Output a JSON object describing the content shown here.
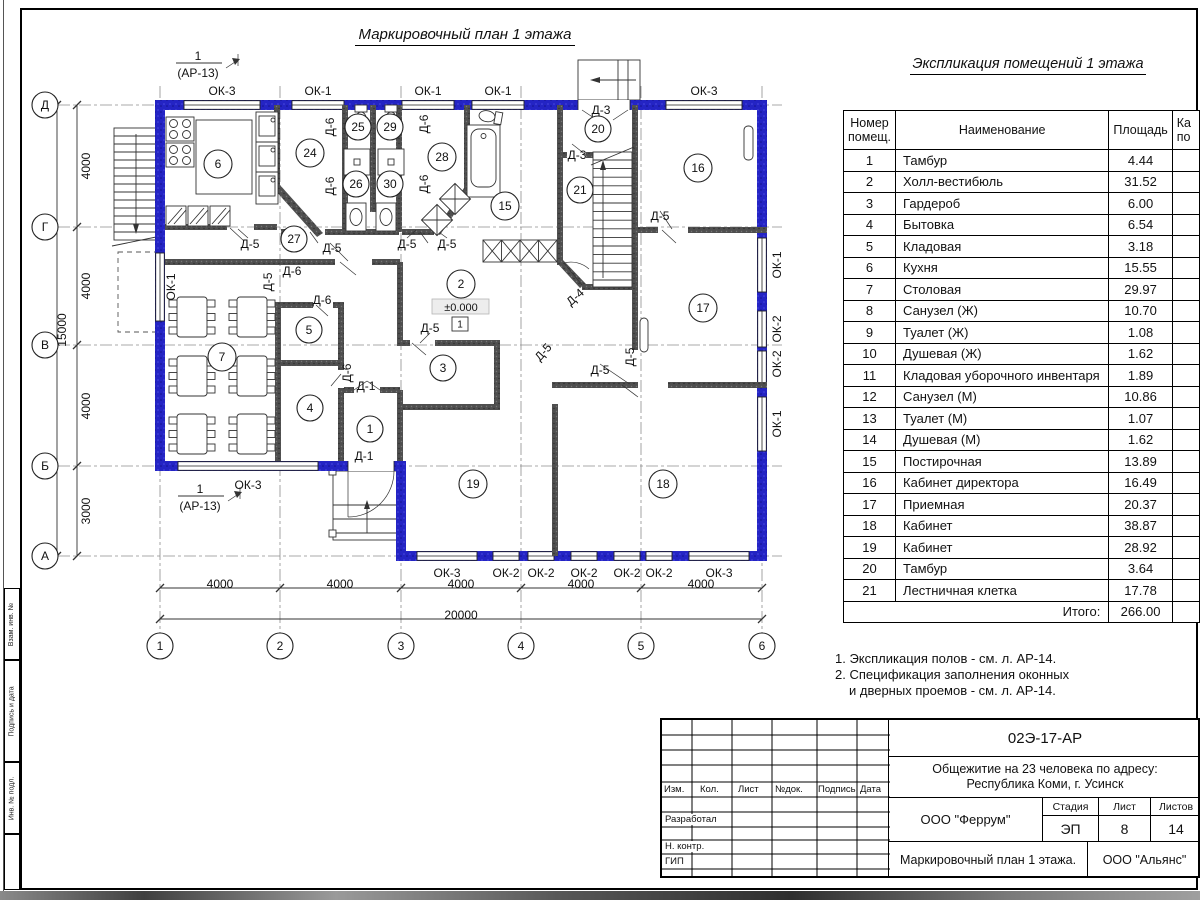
{
  "sheet": {
    "plan_title": "Маркировочный план 1 этажа",
    "table_title": "Экспликация помещений 1 этажа",
    "side_labels": [
      "Взам. инв. №",
      "Подпись и дата",
      "Инв. № подл."
    ]
  },
  "table": {
    "headers": {
      "num": "Номер помещ.",
      "name": "Наименование",
      "area": "Площадь",
      "cut_line1": "Ка",
      "cut_line2": "по"
    },
    "rows": [
      [
        "1",
        "Тамбур",
        "4.44"
      ],
      [
        "2",
        "Холл-вестибюль",
        "31.52"
      ],
      [
        "3",
        "Гардероб",
        "6.00"
      ],
      [
        "4",
        "Бытовка",
        "6.54"
      ],
      [
        "5",
        "Кладовая",
        "3.18"
      ],
      [
        "6",
        "Кухня",
        "15.55"
      ],
      [
        "7",
        "Столовая",
        "29.97"
      ],
      [
        "8",
        "Санузел (Ж)",
        "10.70"
      ],
      [
        "9",
        "Туалет (Ж)",
        "1.08"
      ],
      [
        "10",
        "Душевая (Ж)",
        "1.62"
      ],
      [
        "11",
        "Кладовая уборочного инвентаря",
        "1.89"
      ],
      [
        "12",
        "Санузел (М)",
        "10.86"
      ],
      [
        "13",
        "Туалет (М)",
        "1.07"
      ],
      [
        "14",
        "Душевая (М)",
        "1.62"
      ],
      [
        "15",
        "Постирочная",
        "13.89"
      ],
      [
        "16",
        "Кабинет директора",
        "16.49"
      ],
      [
        "17",
        "Приемная",
        "20.37"
      ],
      [
        "18",
        "Кабинет",
        "38.87"
      ],
      [
        "19",
        "Кабинет",
        "28.92"
      ],
      [
        "20",
        "Тамбур",
        "3.64"
      ],
      [
        "21",
        "Лестничная клетка",
        "17.78"
      ]
    ],
    "total_label": "Итого:",
    "total": "266.00"
  },
  "notes": {
    "line1": "1. Экспликация полов - см. л. АР-14.",
    "line2": "2. Спецификация заполнения оконных",
    "line3": "и дверных проемов - см. л. АР-14."
  },
  "stamp": {
    "code": "02Э-17-АР",
    "project_line1": "Общежитие на 23 человека по адресу:",
    "project_line2": "Республика Коми, г. Усинск",
    "designer_org": "ООО \"Феррум\"",
    "customer_org": "ООО \"Альянс\"",
    "sheet_title": "Маркировочный план 1 этажа.",
    "stage_label": "Стадия",
    "sheet_label": "Лист",
    "sheets_label": "Листов",
    "stage": "ЭП",
    "sheet_num": "8",
    "sheets_total": "14",
    "rev_headers": [
      "Изм.",
      "Кол.",
      "Лист",
      "№док.",
      "Подпись",
      "Дата"
    ],
    "roles": [
      "Разработал",
      "Н. контр.",
      "ГИП"
    ]
  },
  "plan": {
    "colors": {
      "exterior_wall": "#2424c4",
      "interior_wall": "#4f4f4f"
    },
    "texts": [
      {
        "t": "Д",
        "x": 45,
        "y": 105,
        "c": 13
      },
      {
        "t": "Г",
        "x": 45,
        "y": 227,
        "c": 13
      },
      {
        "t": "В",
        "x": 45,
        "y": 345,
        "c": 13
      },
      {
        "t": "Б",
        "x": 45,
        "y": 466,
        "c": 13
      },
      {
        "t": "А",
        "x": 45,
        "y": 556,
        "c": 13
      },
      {
        "t": "1",
        "x": 160,
        "y": 646,
        "c": 13
      },
      {
        "t": "2",
        "x": 280,
        "y": 646,
        "c": 13
      },
      {
        "t": "3",
        "x": 401,
        "y": 646,
        "c": 13
      },
      {
        "t": "4",
        "x": 521,
        "y": 646,
        "c": 13
      },
      {
        "t": "5",
        "x": 641,
        "y": 646,
        "c": 13
      },
      {
        "t": "6",
        "x": 762,
        "y": 646,
        "c": 13
      },
      {
        "t": "6",
        "x": 218,
        "y": 164,
        "c": 14
      },
      {
        "t": "24",
        "x": 310,
        "y": 153,
        "c": 14
      },
      {
        "t": "25",
        "x": 358,
        "y": 127,
        "c": 13
      },
      {
        "t": "29",
        "x": 390,
        "y": 127,
        "c": 13
      },
      {
        "t": "26",
        "x": 356,
        "y": 184,
        "c": 13
      },
      {
        "t": "30",
        "x": 390,
        "y": 184,
        "c": 13
      },
      {
        "t": "28",
        "x": 442,
        "y": 157,
        "c": 14
      },
      {
        "t": "27",
        "x": 294,
        "y": 239,
        "c": 13
      },
      {
        "t": "15",
        "x": 505,
        "y": 206,
        "c": 14
      },
      {
        "t": "20",
        "x": 598,
        "y": 129,
        "c": 13
      },
      {
        "t": "21",
        "x": 580,
        "y": 190,
        "c": 13
      },
      {
        "t": "16",
        "x": 698,
        "y": 168,
        "c": 14
      },
      {
        "t": "17",
        "x": 703,
        "y": 308,
        "c": 14
      },
      {
        "t": "7",
        "x": 222,
        "y": 357,
        "c": 14
      },
      {
        "t": "5",
        "x": 309,
        "y": 330,
        "c": 13
      },
      {
        "t": "4",
        "x": 310,
        "y": 408,
        "c": 13
      },
      {
        "t": "1",
        "x": 370,
        "y": 429,
        "c": 13
      },
      {
        "t": "2",
        "x": 461,
        "y": 284,
        "c": 14
      },
      {
        "t": "3",
        "x": 443,
        "y": 368,
        "c": 13
      },
      {
        "t": "19",
        "x": 473,
        "y": 484,
        "c": 14
      },
      {
        "t": "18",
        "x": 663,
        "y": 484,
        "c": 14
      },
      {
        "t": "ОК-3",
        "x": 222,
        "y": 91
      },
      {
        "t": "ОК-1",
        "x": 318,
        "y": 91
      },
      {
        "t": "ОК-1",
        "x": 428,
        "y": 91
      },
      {
        "t": "ОК-1",
        "x": 498,
        "y": 91
      },
      {
        "t": "ОК-3",
        "x": 704,
        "y": 91
      },
      {
        "t": "ОК-3",
        "x": 248,
        "y": 485
      },
      {
        "t": "ОК-3",
        "x": 447,
        "y": 573
      },
      {
        "t": "ОК-2",
        "x": 506,
        "y": 573
      },
      {
        "t": "ОК-2",
        "x": 541,
        "y": 573
      },
      {
        "t": "ОК-2",
        "x": 584,
        "y": 573
      },
      {
        "t": "ОК-2",
        "x": 627,
        "y": 573
      },
      {
        "t": "ОК-2",
        "x": 659,
        "y": 573
      },
      {
        "t": "ОК-3",
        "x": 719,
        "y": 573
      },
      {
        "t": "ОК-1",
        "x": 171,
        "y": 287,
        "r": -90
      },
      {
        "t": "ОК-1",
        "x": 777,
        "y": 265,
        "r": -90
      },
      {
        "t": "ОК-2",
        "x": 777,
        "y": 329,
        "r": -90
      },
      {
        "t": "ОК-2",
        "x": 777,
        "y": 364,
        "r": -90
      },
      {
        "t": "ОК-1",
        "x": 777,
        "y": 424,
        "r": -90
      },
      {
        "t": "Д-6",
        "x": 330,
        "y": 127,
        "r": -90
      },
      {
        "t": "Д-6",
        "x": 330,
        "y": 186,
        "r": -90
      },
      {
        "t": "Д-6",
        "x": 424,
        "y": 124,
        "r": -90
      },
      {
        "t": "Д-6",
        "x": 424,
        "y": 184,
        "r": -90
      },
      {
        "t": "Д-5",
        "x": 250,
        "y": 244
      },
      {
        "t": "Д-5",
        "x": 332,
        "y": 248
      },
      {
        "t": "Д-5",
        "x": 407,
        "y": 244
      },
      {
        "t": "Д-5",
        "x": 447,
        "y": 244
      },
      {
        "t": "Д-5",
        "x": 660,
        "y": 216
      },
      {
        "t": "Д-6",
        "x": 292,
        "y": 271
      },
      {
        "t": "Д-6",
        "x": 322,
        "y": 300
      },
      {
        "t": "Д-5",
        "x": 268,
        "y": 282,
        "r": -90
      },
      {
        "t": "Д-6",
        "x": 347,
        "y": 373,
        "r": -90
      },
      {
        "t": "Д-1",
        "x": 366,
        "y": 386
      },
      {
        "t": "Д-1",
        "x": 364,
        "y": 456
      },
      {
        "t": "Д-5",
        "x": 430,
        "y": 328
      },
      {
        "t": "Д-5",
        "x": 543,
        "y": 352,
        "r": -48
      },
      {
        "t": "Д-5",
        "x": 600,
        "y": 370
      },
      {
        "t": "Д-5",
        "x": 630,
        "y": 357,
        "r": -90
      },
      {
        "t": "Д-3",
        "x": 601,
        "y": 110
      },
      {
        "t": "Д-3",
        "x": 577,
        "y": 155
      },
      {
        "t": "Д-4",
        "x": 575,
        "y": 297,
        "r": -42
      },
      {
        "t": "4000",
        "x": 220,
        "y": 584
      },
      {
        "t": "4000",
        "x": 340,
        "y": 584
      },
      {
        "t": "4000",
        "x": 461,
        "y": 584
      },
      {
        "t": "4000",
        "x": 581,
        "y": 584
      },
      {
        "t": "4000",
        "x": 701,
        "y": 584
      },
      {
        "t": "20000",
        "x": 461,
        "y": 615
      },
      {
        "t": "4000",
        "x": 86,
        "y": 166,
        "r": -90
      },
      {
        "t": "4000",
        "x": 86,
        "y": 286,
        "r": -90
      },
      {
        "t": "4000",
        "x": 86,
        "y": 406,
        "r": -90
      },
      {
        "t": "3000",
        "x": 86,
        "y": 511,
        "r": -90
      },
      {
        "t": "15000",
        "x": 62,
        "y": 330,
        "r": -90
      },
      {
        "t": "1",
        "x": 198,
        "y": 56
      },
      {
        "t": "(АР-13)",
        "x": 198,
        "y": 73
      },
      {
        "t": "1",
        "x": 200,
        "y": 489
      },
      {
        "t": "(АР-13)",
        "x": 200,
        "y": 506
      },
      {
        "t": "±0.000",
        "x": 461,
        "y": 307,
        "fs": 11
      },
      {
        "t": "1",
        "x": 460,
        "y": 324,
        "fs": 10
      }
    ]
  }
}
